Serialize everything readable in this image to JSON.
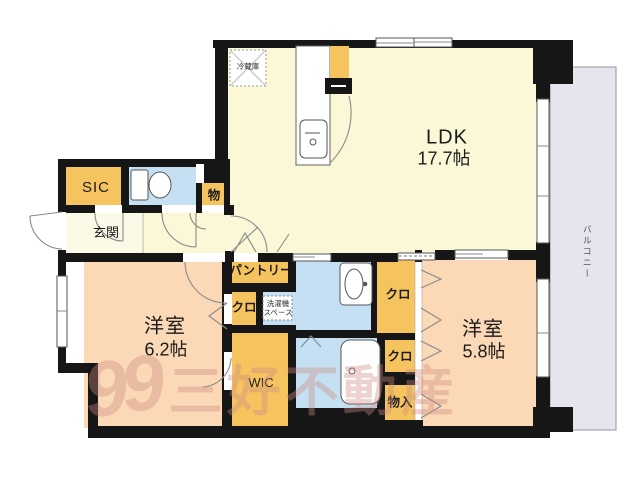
{
  "plan": {
    "type": "floorplan",
    "labels": {
      "ldk": "LDK",
      "ldk_size": "17.7帖",
      "bedroom1": "洋室",
      "bedroom1_size": "6.2帖",
      "bedroom2": "洋室",
      "bedroom2_size": "5.8帖",
      "genkan": "玄関",
      "sic": "SIC",
      "mono": "物",
      "pantry": "パントリー",
      "closet_hall": "クロ",
      "laundry_line1": "洗濯機",
      "laundry_line2": "スペース",
      "wic": "WIC",
      "closet1": "クロ",
      "closet2": "クロ",
      "monoire": "物入",
      "fridge": "冷蔵庫",
      "balcony": "バルコニー"
    },
    "watermark": {
      "logo": "99",
      "text": "三好不動産"
    },
    "colors": {
      "wall": "#161616",
      "ldk_floor": "#FAF8D6",
      "genkan_floor": "#FAFAE6",
      "bedroom_floor": "#FBD8B6",
      "closet_orange": "#F5C45F",
      "wet_area_blue": "#C5E0F2",
      "balcony_gray": "#E6E4EC",
      "watermark_pink": "#CD8C82"
    }
  }
}
